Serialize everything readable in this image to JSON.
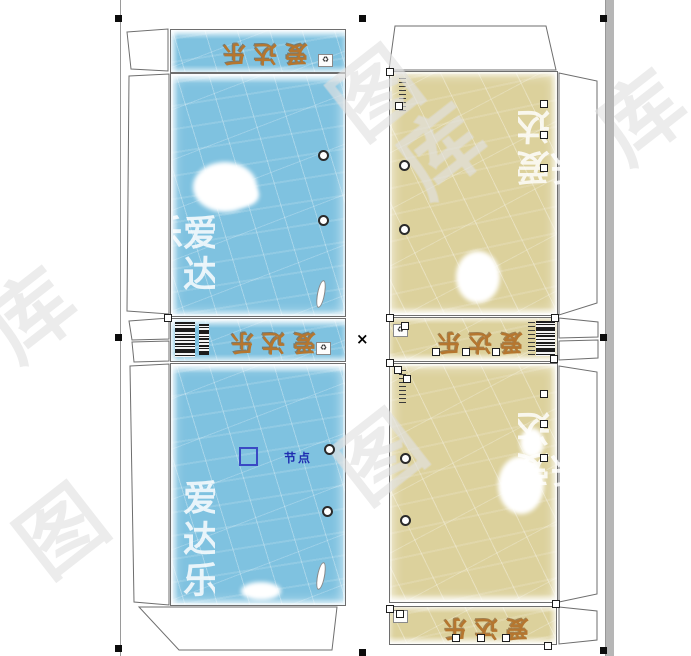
{
  "editor": {
    "node_tooltip_label": "节点",
    "selection_center_mark": "×",
    "recycle_icon": "♻"
  },
  "watermark": {
    "characters": [
      "图",
      "库"
    ]
  },
  "colors": {
    "blue_panel": "#7fc2e0",
    "tan_panel": "#dcd19c",
    "brand_orange": "#b5762f",
    "die_line": "#6e6e6e",
    "node_blue": "#3a49c4",
    "scrollbar_gray": "#b6b6b6"
  },
  "left_box": {
    "top_flap_label": "爱达乐",
    "mid_strip_label": "爱达乐",
    "ghost_label_top": "爱达乐",
    "ghost_label_bottom": "爱达乐"
  },
  "right_box": {
    "mid_strip_label": "爱达乐",
    "bottom_flap_label": "爱达乐",
    "ghost_label_top": "爱达乐",
    "ghost_label_bottom": "爱达乐"
  }
}
